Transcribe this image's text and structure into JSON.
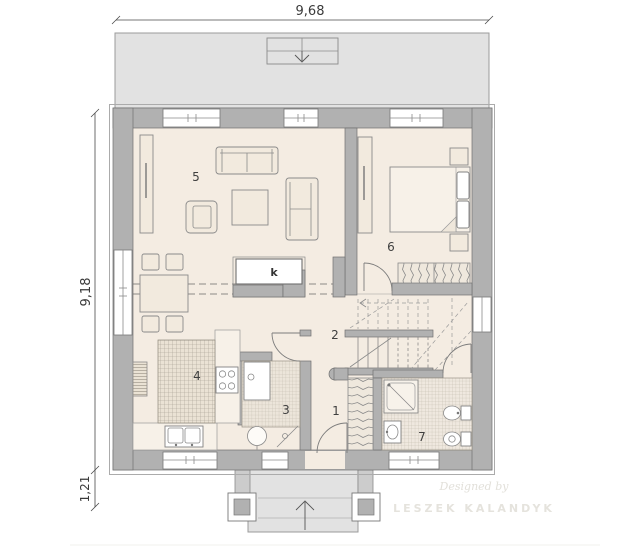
{
  "dimensions": {
    "top": "9,68",
    "left": "9,18",
    "porch": "1,21"
  },
  "rooms": {
    "hall": "1",
    "staircase": "2",
    "toilet": "3",
    "kitchen": "4",
    "living": "5",
    "bedroom": "6",
    "bathroom": "7"
  },
  "fireplace": {
    "label": "k"
  },
  "watermark": {
    "line1": "Designed by",
    "line2": "LESZEK KALANDYK"
  },
  "colors": {
    "floor": "#f4ece2",
    "wall": "#b1b1b1",
    "terrace": "#e2e2e2",
    "dimension_text": "#3a3a3a",
    "watermark": "#e5e3dd"
  }
}
